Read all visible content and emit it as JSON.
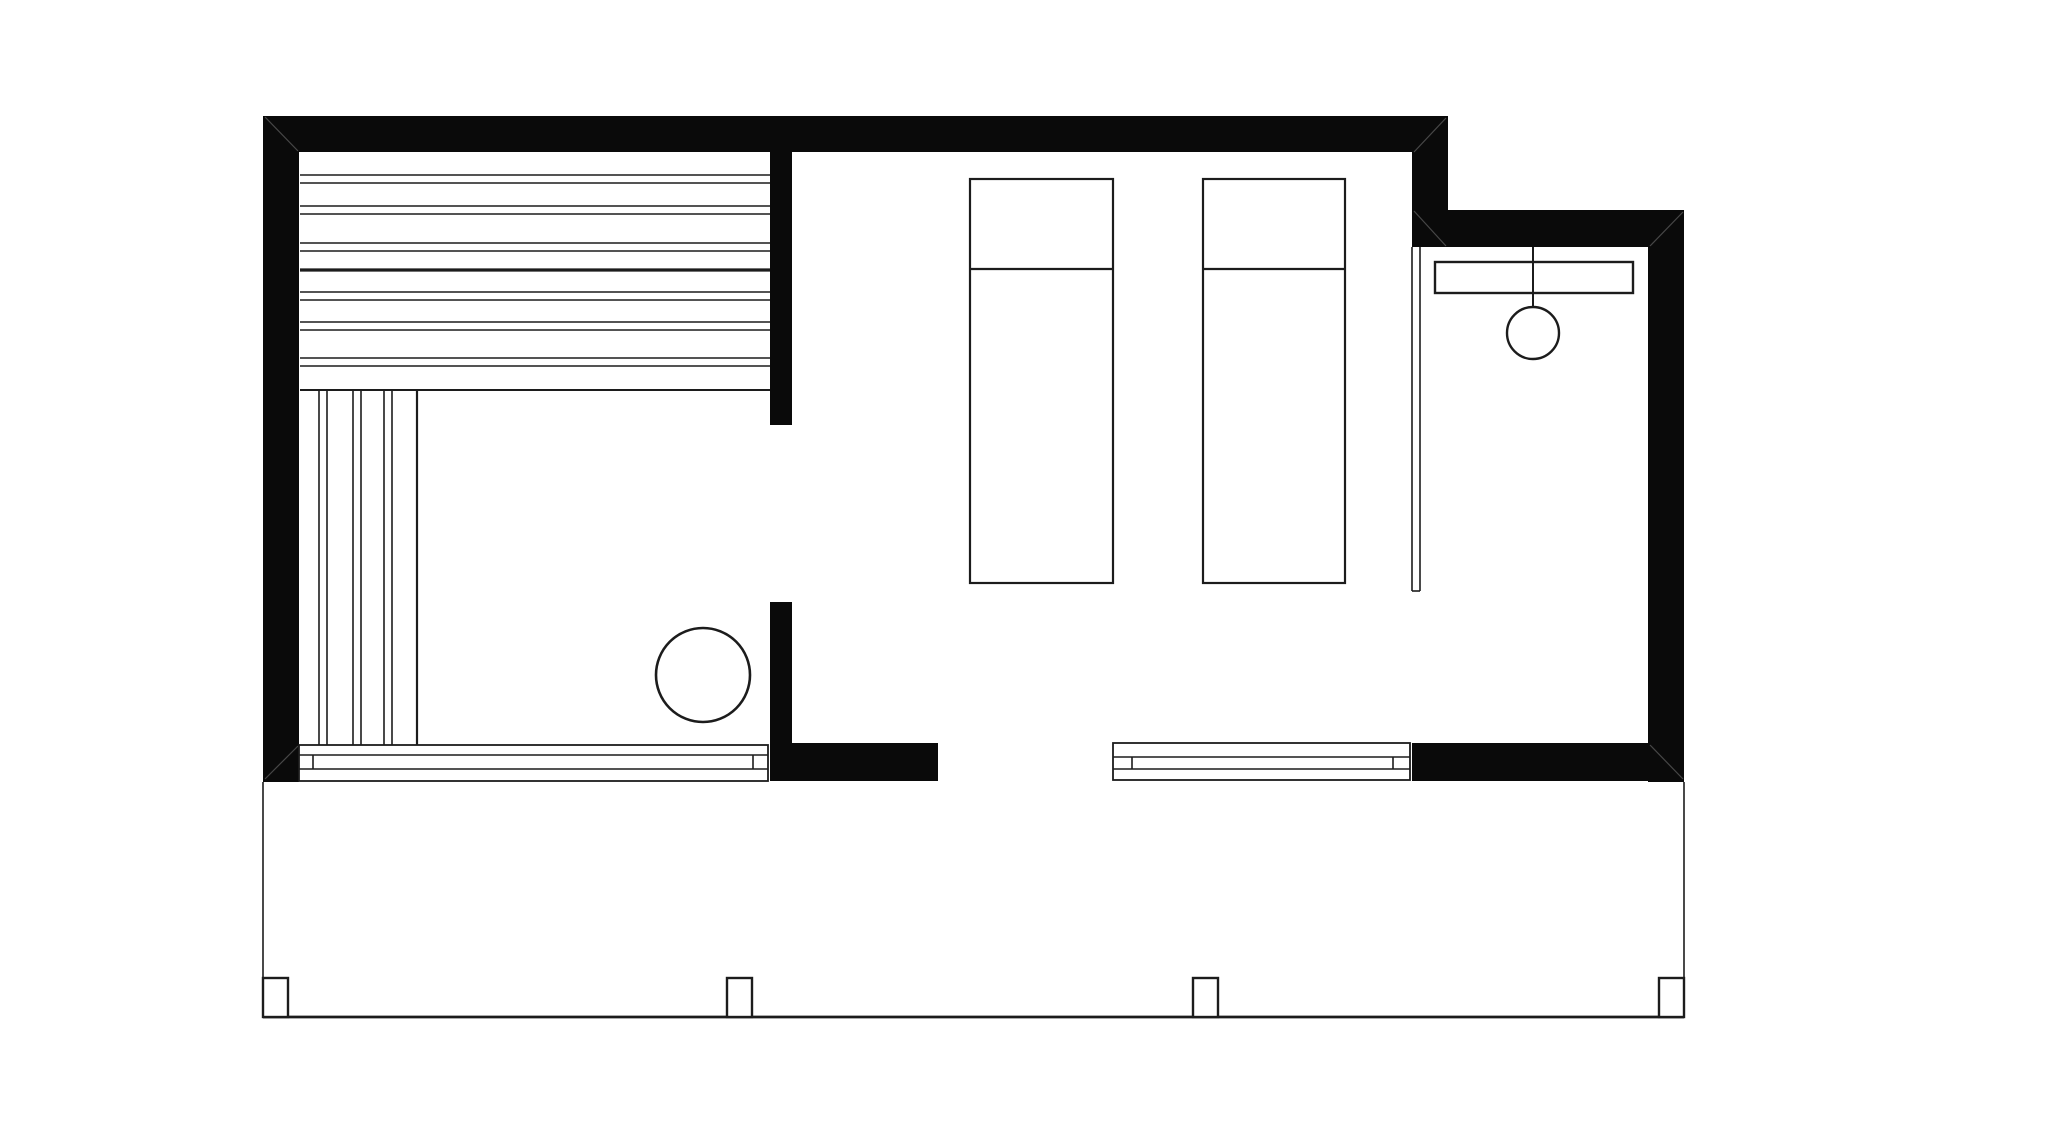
{
  "canvas": {
    "width": 2048,
    "height": 1136,
    "background": "#ffffff",
    "wall_fill": "#0a0a0a",
    "line_color": "#1c1c1c",
    "seam_color": "#474747"
  },
  "plan": {
    "walls": [
      {
        "name": "wall-top",
        "x": 263,
        "y": 116,
        "w": 1185,
        "h": 36
      },
      {
        "name": "wall-left",
        "x": 263,
        "y": 116,
        "w": 36,
        "h": 666
      },
      {
        "name": "wall-step-connector",
        "x": 1412,
        "y": 152,
        "w": 36,
        "h": 95
      },
      {
        "name": "wall-bath-top",
        "x": 1412,
        "y": 210,
        "w": 272,
        "h": 37
      },
      {
        "name": "wall-bath-right",
        "x": 1648,
        "y": 210,
        "w": 36,
        "h": 572
      },
      {
        "name": "wall-bottom-entry",
        "x": 770,
        "y": 743,
        "w": 168,
        "h": 38
      },
      {
        "name": "wall-bottom-bath",
        "x": 1412,
        "y": 743,
        "w": 236,
        "h": 38
      },
      {
        "name": "wall-sauna-partition-upper",
        "x": 770,
        "y": 152,
        "w": 22,
        "h": 273
      },
      {
        "name": "wall-sauna-partition-jamb",
        "x": 770,
        "y": 602,
        "w": 22,
        "h": 141
      }
    ],
    "miter_seams": [
      {
        "name": "seam-top-left-corner",
        "x1": 265,
        "y1": 117,
        "x2": 298,
        "y2": 151
      },
      {
        "name": "seam-top-wall-right-end",
        "x1": 1446,
        "y1": 118,
        "x2": 1414,
        "y2": 152
      },
      {
        "name": "seam-step-to-bath-wall",
        "x1": 1414,
        "y1": 211,
        "x2": 1446,
        "y2": 246
      },
      {
        "name": "seam-bath-top-right",
        "x1": 1683,
        "y1": 212,
        "x2": 1650,
        "y2": 246
      },
      {
        "name": "seam-bath-bottom-right",
        "x1": 1650,
        "y1": 745,
        "x2": 1683,
        "y2": 779
      },
      {
        "name": "seam-left-wall-bottom",
        "x1": 265,
        "y1": 779,
        "x2": 298,
        "y2": 746
      }
    ],
    "sauna": {
      "bench_boards_x1": 300,
      "bench_boards_x2": 770,
      "bench_board_lines": [
        {
          "y": 175,
          "w": 1.6
        },
        {
          "y": 183,
          "w": 1.6
        },
        {
          "y": 206,
          "w": 1.6
        },
        {
          "y": 214,
          "w": 1.6
        },
        {
          "y": 243,
          "w": 1.6
        },
        {
          "y": 251,
          "w": 1.6
        },
        {
          "y": 270,
          "w": 3.2
        },
        {
          "y": 292,
          "w": 1.6
        },
        {
          "y": 300,
          "w": 1.6
        },
        {
          "y": 322,
          "w": 1.6
        },
        {
          "y": 330,
          "w": 1.6
        },
        {
          "y": 358,
          "w": 1.6
        },
        {
          "y": 366,
          "w": 1.6
        },
        {
          "y": 390,
          "w": 2.0
        }
      ],
      "floor_boards_y1": 390,
      "floor_boards_y2": 745,
      "floor_board_lines": [
        {
          "x": 319,
          "w": 1.6
        },
        {
          "x": 327,
          "w": 1.6
        },
        {
          "x": 353,
          "w": 1.6
        },
        {
          "x": 361,
          "w": 1.6
        },
        {
          "x": 384,
          "w": 1.6
        },
        {
          "x": 392,
          "w": 1.6
        },
        {
          "x": 417,
          "w": 2.2
        }
      ],
      "stove": {
        "cx": 703,
        "cy": 675,
        "r": 47,
        "sw": 2.6
      }
    },
    "lounge": {
      "loungers": [
        {
          "name": "lounger-1",
          "x": 970,
          "y": 179,
          "w": 143,
          "h": 404,
          "pillow_y": 269,
          "sw": 2.2
        },
        {
          "name": "lounger-2",
          "x": 1203,
          "y": 179,
          "w": 142,
          "h": 404,
          "pillow_y": 269,
          "sw": 2.2
        }
      ]
    },
    "bath": {
      "partition": {
        "x1": 1412,
        "x2": 1420,
        "y1": 247,
        "y2": 591,
        "sw": 1.6
      },
      "shelf": {
        "x": 1435,
        "y": 262,
        "w": 198,
        "h": 31,
        "sw": 2.4
      },
      "pendant": {
        "x": 1533,
        "drop_y1": 247,
        "drop_y2": 307,
        "cy": 333,
        "r": 26,
        "sw": 2.4
      }
    },
    "glazing": [
      {
        "name": "sauna-window-bench",
        "x": 299,
        "y": 745,
        "w": 469,
        "h": 36,
        "mid1": 755,
        "mid2": 769,
        "tick1": 313,
        "tick2": 753,
        "sw": 1.8
      },
      {
        "name": "terrace-door-track",
        "x": 1113,
        "y": 743,
        "w": 297,
        "h": 37,
        "mid1": 757,
        "mid2": 769,
        "tick1": 1132,
        "tick2": 1393,
        "sw": 1.8
      }
    ],
    "terrace": {
      "left_edge": {
        "x": 263,
        "y1": 782,
        "y2": 1017,
        "sw": 1.6
      },
      "right_edge": {
        "x": 1684,
        "y1": 782,
        "y2": 1017,
        "sw": 1.6
      },
      "bottom_edge": {
        "y": 1017,
        "x1": 263,
        "x2": 1684,
        "sw": 2.8
      },
      "post_y": 978,
      "post_w": 25,
      "post_h": 39,
      "post_sw": 2.4,
      "posts": [
        {
          "x": 263
        },
        {
          "x": 727
        },
        {
          "x": 1193
        },
        {
          "x": 1659
        }
      ]
    }
  }
}
